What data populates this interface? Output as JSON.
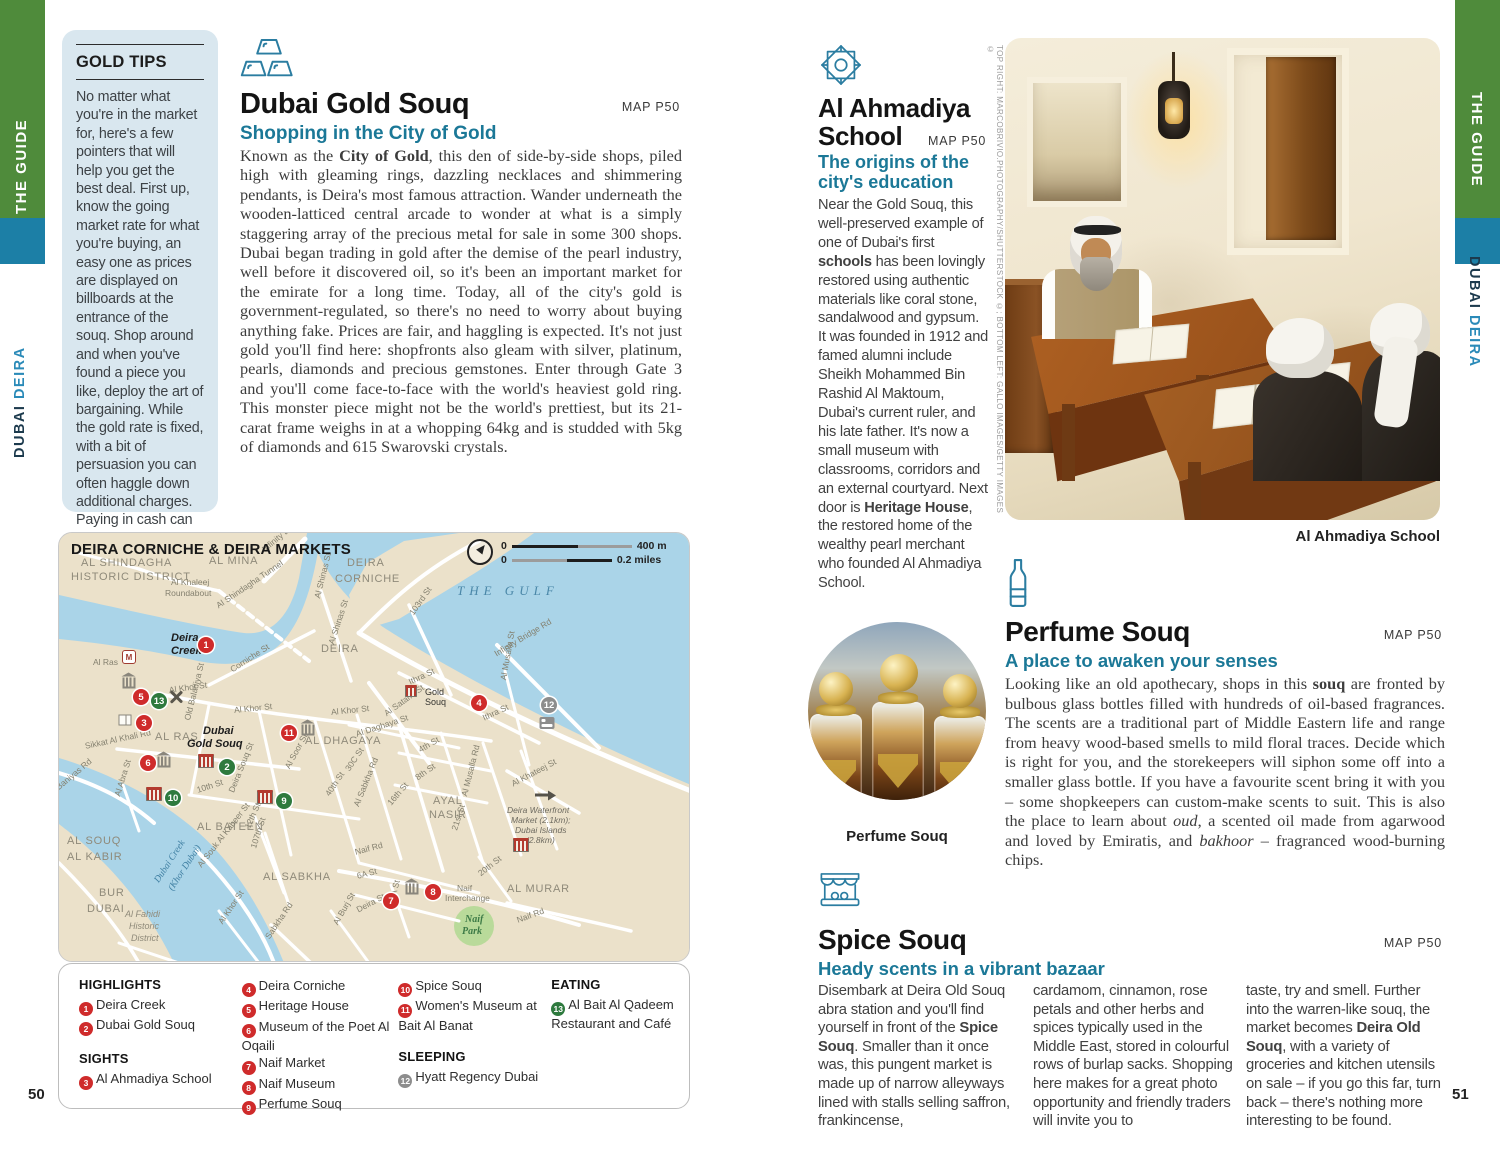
{
  "page": {
    "left_num": "50",
    "right_num": "51"
  },
  "edges": {
    "guide": "THE GUIDE",
    "city": "DUBAI",
    "area": "DEIRA",
    "city_area_down": "DUBAI DEIRA"
  },
  "colors": {
    "accent_teal": "#1b7897",
    "edge_green": "#4f8b3b",
    "edge_blue": "#1c7fa6",
    "marker_red": "#cf2b2b",
    "marker_green": "#2e7a3e",
    "marker_gray": "#8d8d8d"
  },
  "gold_tips": {
    "title": "GOLD TIPS",
    "body": "No matter what you're in the market for, here's a few pointers that will help you get the best deal. First up, know the going market rate for what you're buying, an easy one as prices are displayed on billboards at the entrance of the souq. Shop around and when you've found a piece you like, deploy the art of bargaining. While the gold rate is fixed, with a bit of persuasion you can often haggle down additional charges. Paying in cash can also boost your bargaining power."
  },
  "gold_souq": {
    "title": "Dubai Gold Souq",
    "map_ref": "MAP P50",
    "subtitle": "Shopping in the City of Gold",
    "body": [
      {
        "t": "Known as the "
      },
      {
        "t": "City of Gold",
        "b": true
      },
      {
        "t": ", this den of side-by-side shops, piled high with gleaming rings, dazzling necklaces and shimmering pendants, is Deira's most famous attraction. Wander underneath the wooden-latticed central arcade to wonder at what is a simply staggering array of the precious metal for sale in some 300 shops. Dubai began trading in gold after the demise of the pearl industry, well before it discovered oil, so it's been an important market for the emirate for a long time. Today, all of the city's gold is government-regulated, so there's no need to worry about buying anything fake. Prices are fair, and haggling is expected. It's not just gold you'll find here: shopfronts also gleam with silver, platinum, pearls, diamonds and precious gemstones. Enter through Gate 3 and you'll come face-to-face with the world's heaviest gold ring. This monster piece might not be the world's prettiest, but its 21-carat frame weighs in at a whopping 64kg and is studded with 5kg of diamonds and 615 Swarovski crystals."
      }
    ]
  },
  "ahmadiya": {
    "title_line1": "Al Ahmadiya",
    "title_line2": "School",
    "map_ref": "MAP P50",
    "subtitle": "The origins of the city's education",
    "body": [
      {
        "t": "Near the Gold Souq, this well-preserved example of one of Dubai's first "
      },
      {
        "t": "schools",
        "b": true
      },
      {
        "t": " has been lovingly restored using authentic materials like coral stone, sandalwood and gypsum. It was founded in 1912 and famed alumni include Sheikh Mohammed Bin Rashid Al Maktoum, Dubai's current ruler, and his late father. It's now a small museum with classrooms, corridors and an external courtyard. Next door is "
      },
      {
        "t": "Heritage House",
        "b": true
      },
      {
        "t": ", the restored home of the wealthy pearl merchant who founded Al Ahmadiya School."
      }
    ],
    "photo_caption": "Al Ahmadiya School",
    "credit": "TOP RIGHT: MARCOBRIVIO.PHOTOGRAPHY/SHUTTERSTOCK ©; BOTTOM LEFT: GALLO IMAGES/GETTY IMAGES ©"
  },
  "perfume": {
    "title": "Perfume Souq",
    "map_ref": "MAP P50",
    "subtitle": "A place to awaken your senses",
    "photo_caption": "Perfume Souq",
    "body": [
      {
        "t": "Looking like an old apothecary, shops in this "
      },
      {
        "t": "souq",
        "b": true
      },
      {
        "t": " are fronted by bulbous glass bottles filled with hundreds of oil-based fragrances. The scents are a traditional part of Middle Eastern life and range from heavy wood-based smells to mild floral traces. Decide which is right for you, and the storekeepers will siphon some off into a smaller glass bottle. If you have a favourite scent bring it with you – some shopkeepers can custom-make scents to suit. This is also the place to learn about "
      },
      {
        "t": "oud",
        "i": true
      },
      {
        "t": ", a scented oil made from agarwood and loved by Emiratis, and "
      },
      {
        "t": "bakhoor",
        "i": true
      },
      {
        "t": " – fragranced wood-burning chips."
      }
    ]
  },
  "spice": {
    "title": "Spice Souq",
    "map_ref": "MAP P50",
    "subtitle": "Heady scents in a vibrant bazaar",
    "col1": [
      {
        "t": "Disembark at Deira Old Souq abra station and you'll find yourself in front of the "
      },
      {
        "t": "Spice Souq",
        "b": true
      },
      {
        "t": ". Smaller than it once was, this pungent market is made up of narrow alleyways lined with stalls selling saffron, frankincense,"
      }
    ],
    "col2": [
      {
        "t": "cardamom, cinnamon, rose petals and other herbs and spices typically used in the Middle East, stored in colourful rows of burlap sacks. Shopping here makes for a great photo opportunity and friendly traders will invite you to"
      }
    ],
    "col3": [
      {
        "t": "taste, try and smell. Further into the warren-like souq, the market becomes "
      },
      {
        "t": "Deira Old Souq",
        "b": true
      },
      {
        "t": ", with a variety of groceries and kitchen utensils on sale – if you go this far, turn back – there's nothing more interesting to be found."
      }
    ]
  },
  "map": {
    "title": "DEIRA CORNICHE & DEIRA MARKETS",
    "scale": {
      "zero1": "0",
      "m": "400 m",
      "zero2": "0",
      "mi": "0.2 miles"
    },
    "labels": [
      {
        "t": "AL SHINDAGHA",
        "x": 22,
        "y": 24,
        "cls": "district"
      },
      {
        "t": "HISTORIC DISTRICT",
        "x": 12,
        "y": 38,
        "cls": "district"
      },
      {
        "t": "AL MINA",
        "x": 150,
        "y": 22,
        "cls": "district"
      },
      {
        "t": "DEIRA",
        "x": 288,
        "y": 24,
        "cls": "district"
      },
      {
        "t": "CORNICHE",
        "x": 276,
        "y": 40,
        "cls": "district"
      },
      {
        "t": "THE GULF",
        "x": 398,
        "y": 50,
        "cls": "gulf"
      },
      {
        "t": "DEIRA",
        "x": 262,
        "y": 110,
        "cls": "district"
      },
      {
        "t": "AL RAS",
        "x": 96,
        "y": 198,
        "cls": "district"
      },
      {
        "t": "AL DHAGAYA",
        "x": 246,
        "y": 202,
        "cls": "district"
      },
      {
        "t": "AYAL",
        "x": 374,
        "y": 262,
        "cls": "district"
      },
      {
        "t": "NASIR",
        "x": 370,
        "y": 276,
        "cls": "district"
      },
      {
        "t": "AL BATEEN",
        "x": 138,
        "y": 288,
        "cls": "district"
      },
      {
        "t": "AL SABKHA",
        "x": 204,
        "y": 338,
        "cls": "district"
      },
      {
        "t": "AL SOUQ",
        "x": 8,
        "y": 302,
        "cls": "district"
      },
      {
        "t": "AL KABIR",
        "x": 8,
        "y": 318,
        "cls": "district"
      },
      {
        "t": "BUR",
        "x": 40,
        "y": 354,
        "cls": "district"
      },
      {
        "t": "DUBAI",
        "x": 28,
        "y": 370,
        "cls": "district"
      },
      {
        "t": "AL MURAR",
        "x": 448,
        "y": 350,
        "cls": "district"
      },
      {
        "t": "Al Fahidi",
        "x": 66,
        "y": 376,
        "cls": "hist"
      },
      {
        "t": "Historic",
        "x": 70,
        "y": 388,
        "cls": "hist"
      },
      {
        "t": "District",
        "x": 72,
        "y": 400,
        "cls": "hist"
      },
      {
        "t": "Dubai Creek",
        "x": 98,
        "y": 344,
        "cls": "water",
        "rot": -57
      },
      {
        "t": "(Khor Dubai)",
        "x": 112,
        "y": 352,
        "cls": "water",
        "rot": -57
      },
      {
        "t": "Naif",
        "x": 406,
        "y": 381,
        "cls": "park"
      },
      {
        "t": "Park",
        "x": 403,
        "y": 393,
        "cls": "park"
      },
      {
        "t": "Naif",
        "x": 398,
        "y": 350,
        "cls": "street"
      },
      {
        "t": "Interchange",
        "x": 386,
        "y": 360,
        "cls": "street"
      },
      {
        "t": "Deira",
        "x": 112,
        "y": 99,
        "cls": "place"
      },
      {
        "t": "Creek",
        "x": 112,
        "y": 112,
        "cls": "place"
      },
      {
        "t": "Dubai",
        "x": 144,
        "y": 192,
        "cls": "place"
      },
      {
        "t": "Gold Souq",
        "x": 128,
        "y": 205,
        "cls": "place"
      },
      {
        "t": "Gold",
        "x": 366,
        "y": 154,
        "cls": "splace"
      },
      {
        "t": "Souq",
        "x": 366,
        "y": 164,
        "cls": "splace"
      },
      {
        "t": "Al Ras",
        "x": 34,
        "y": 124,
        "cls": "street"
      },
      {
        "t": "Infinity Bridge",
        "x": 204,
        "y": 12,
        "cls": "street",
        "rot": -40
      },
      {
        "t": "Al Khaleej",
        "x": 112,
        "y": 44,
        "cls": "street"
      },
      {
        "t": "Roundabout",
        "x": 106,
        "y": 55,
        "cls": "street"
      },
      {
        "t": "Al Shindagha Tunnel",
        "x": 158,
        "y": 68,
        "cls": "street",
        "rot": -34
      },
      {
        "t": "Al Shinas St",
        "x": 258,
        "y": 60,
        "cls": "street",
        "rot": -76
      },
      {
        "t": "Al Shinas St",
        "x": 272,
        "y": 106,
        "cls": "street",
        "rot": -72
      },
      {
        "t": "103rd St",
        "x": 352,
        "y": 76,
        "cls": "street",
        "rot": -55
      },
      {
        "t": "Infinity Bridge Rd",
        "x": 436,
        "y": 116,
        "cls": "street",
        "rot": -31
      },
      {
        "t": "Al Musalla St",
        "x": 444,
        "y": 142,
        "cls": "street",
        "rot": -80
      },
      {
        "t": "Ithra St",
        "x": 350,
        "y": 144,
        "cls": "street",
        "rot": -25
      },
      {
        "t": "Ithra St",
        "x": 424,
        "y": 180,
        "cls": "street",
        "rot": -25
      },
      {
        "t": "Corniche St",
        "x": 172,
        "y": 132,
        "cls": "street",
        "rot": -33
      },
      {
        "t": "Al Khor St",
        "x": 110,
        "y": 152,
        "cls": "street",
        "rot": -8
      },
      {
        "t": "Al Khor St",
        "x": 175,
        "y": 172,
        "cls": "street",
        "rot": -6
      },
      {
        "t": "Al Khor St",
        "x": 272,
        "y": 174,
        "cls": "street",
        "rot": -6
      },
      {
        "t": "Al Satami St",
        "x": 326,
        "y": 176,
        "cls": "street",
        "rot": -36
      },
      {
        "t": "Al Daghaya St",
        "x": 297,
        "y": 196,
        "cls": "street",
        "rot": -18
      },
      {
        "t": "4th St",
        "x": 360,
        "y": 212,
        "cls": "street",
        "rot": -30
      },
      {
        "t": "8th St",
        "x": 357,
        "y": 240,
        "cls": "street",
        "rot": -35
      },
      {
        "t": "30C St",
        "x": 288,
        "y": 232,
        "cls": "street",
        "rot": -56
      },
      {
        "t": "40th St",
        "x": 268,
        "y": 257,
        "cls": "street",
        "rot": -56
      },
      {
        "t": "Al Sabkha Rd",
        "x": 297,
        "y": 268,
        "cls": "street",
        "rot": -68
      },
      {
        "t": "16th St",
        "x": 330,
        "y": 266,
        "cls": "street",
        "rot": -50
      },
      {
        "t": "Old Baladiya St",
        "x": 128,
        "y": 182,
        "cls": "street",
        "rot": -76
      },
      {
        "t": "Sikkat Al Khali Rd",
        "x": 26,
        "y": 208,
        "cls": "street",
        "rot": -12
      },
      {
        "t": "Baniyas Rd",
        "x": -2,
        "y": 250,
        "cls": "street",
        "rot": -40
      },
      {
        "t": "Al Abra St",
        "x": 58,
        "y": 258,
        "cls": "street",
        "rot": -73
      },
      {
        "t": "10th St",
        "x": 138,
        "y": 252,
        "cls": "street",
        "rot": -18
      },
      {
        "t": "Deira Souq St",
        "x": 172,
        "y": 254,
        "cls": "street",
        "rot": -68
      },
      {
        "t": "Al Soor St",
        "x": 228,
        "y": 230,
        "cls": "street",
        "rot": -62
      },
      {
        "t": "12th St",
        "x": 188,
        "y": 290,
        "cls": "street",
        "rot": -66
      },
      {
        "t": "107th St",
        "x": 194,
        "y": 310,
        "cls": "street",
        "rot": -72
      },
      {
        "t": "Al Souk Al Kabeer St",
        "x": 140,
        "y": 328,
        "cls": "street",
        "rot": -52
      },
      {
        "t": "Al Khor St",
        "x": 161,
        "y": 385,
        "cls": "street",
        "rot": -56
      },
      {
        "t": "Sabkha Rd",
        "x": 208,
        "y": 400,
        "cls": "street",
        "rot": -56
      },
      {
        "t": "Al Burj St",
        "x": 276,
        "y": 386,
        "cls": "street",
        "rot": -60
      },
      {
        "t": "6A St",
        "x": 298,
        "y": 338,
        "cls": "street",
        "rot": -15
      },
      {
        "t": "Deira St",
        "x": 298,
        "y": 372,
        "cls": "street",
        "rot": -28
      },
      {
        "t": "9A St",
        "x": 333,
        "y": 362,
        "cls": "street",
        "rot": -76
      },
      {
        "t": "Naif Rd",
        "x": 296,
        "y": 314,
        "cls": "street",
        "rot": -15
      },
      {
        "t": "Naif Rd",
        "x": 458,
        "y": 382,
        "cls": "street",
        "rot": -20
      },
      {
        "t": "20th St",
        "x": 420,
        "y": 336,
        "cls": "street",
        "rot": -38
      },
      {
        "t": "21st St",
        "x": 395,
        "y": 292,
        "cls": "street",
        "rot": -72
      },
      {
        "t": "Al Musalla Rd",
        "x": 405,
        "y": 258,
        "cls": "street",
        "rot": -76
      },
      {
        "t": "Al Khateej St",
        "x": 453,
        "y": 246,
        "cls": "street",
        "rot": -28
      },
      {
        "t": "Deira Waterfront",
        "x": 448,
        "y": 272,
        "cls": "note"
      },
      {
        "t": "Market (2.1km);",
        "x": 452,
        "y": 282,
        "cls": "note"
      },
      {
        "t": "Dubai Islands",
        "x": 456,
        "y": 292,
        "cls": "note"
      },
      {
        "t": "(2.8km)",
        "x": 467,
        "y": 302,
        "cls": "note"
      }
    ],
    "markers": [
      {
        "n": "1",
        "x": 147,
        "y": 112,
        "c": "r"
      },
      {
        "n": "2",
        "x": 168,
        "y": 234,
        "c": "g"
      },
      {
        "n": "3",
        "x": 85,
        "y": 190,
        "c": "r"
      },
      {
        "n": "4",
        "x": 420,
        "y": 170,
        "c": "r"
      },
      {
        "n": "5",
        "x": 82,
        "y": 164,
        "c": "r"
      },
      {
        "n": "6",
        "x": 89,
        "y": 230,
        "c": "r"
      },
      {
        "n": "7",
        "x": 332,
        "y": 368,
        "c": "r"
      },
      {
        "n": "8",
        "x": 374,
        "y": 359,
        "c": "r"
      },
      {
        "n": "9",
        "x": 225,
        "y": 268,
        "c": "g"
      },
      {
        "n": "10",
        "x": 114,
        "y": 265,
        "c": "g"
      },
      {
        "n": "11",
        "x": 230,
        "y": 200,
        "c": "r"
      },
      {
        "n": "12",
        "x": 490,
        "y": 172,
        "c": "y"
      },
      {
        "n": "13",
        "x": 100,
        "y": 168,
        "c": "g"
      }
    ],
    "icons": [
      {
        "t": "metro",
        "x": 70,
        "y": 124
      },
      {
        "t": "museum",
        "x": 70,
        "y": 150
      },
      {
        "t": "book",
        "x": 66,
        "y": 187
      },
      {
        "t": "fork",
        "x": 117,
        "y": 164
      },
      {
        "t": "museum",
        "x": 105,
        "y": 229
      },
      {
        "t": "souq",
        "x": 147,
        "y": 228
      },
      {
        "t": "souq",
        "x": 95,
        "y": 261
      },
      {
        "t": "souq",
        "x": 206,
        "y": 264
      },
      {
        "t": "museum",
        "x": 249,
        "y": 197
      },
      {
        "t": "museum",
        "x": 353,
        "y": 356
      },
      {
        "t": "bed",
        "x": 488,
        "y": 190
      },
      {
        "t": "souqsm",
        "x": 352,
        "y": 158
      },
      {
        "t": "arrow",
        "x": 483,
        "y": 262
      },
      {
        "t": "souq",
        "x": 462,
        "y": 312
      }
    ],
    "legend": {
      "columns": [
        [
          {
            "header": "HIGHLIGHTS",
            "items": [
              {
                "n": "1",
                "c": "r",
                "t": "Deira Creek"
              },
              {
                "n": "2",
                "c": "r",
                "t": "Dubai Gold Souq"
              }
            ]
          },
          {
            "header": "SIGHTS",
            "items": [
              {
                "n": "3",
                "c": "r",
                "t": "Al Ahmadiya School"
              }
            ]
          }
        ],
        [
          {
            "items": [
              {
                "n": "4",
                "c": "r",
                "t": "Deira Corniche"
              },
              {
                "n": "5",
                "c": "r",
                "t": "Heritage House"
              },
              {
                "n": "6",
                "c": "r",
                "t": "Museum of the Poet Al Oqaili"
              },
              {
                "n": "7",
                "c": "r",
                "t": "Naif Market"
              },
              {
                "n": "8",
                "c": "r",
                "t": "Naif Museum"
              },
              {
                "n": "9",
                "c": "r",
                "t": "Perfume Souq"
              }
            ]
          }
        ],
        [
          {
            "items": [
              {
                "n": "10",
                "c": "r",
                "t": "Spice Souq"
              },
              {
                "n": "11",
                "c": "r",
                "t": "Women's Museum at Bait Al Banat"
              }
            ]
          },
          {
            "header": "SLEEPING",
            "items": [
              {
                "n": "12",
                "c": "y",
                "t": "Hyatt Regency Dubai"
              }
            ]
          }
        ],
        [
          {
            "header": "EATING",
            "items": [
              {
                "n": "13",
                "c": "g",
                "t": "Al Bait Al Qadeem Restaurant and Café"
              }
            ]
          }
        ]
      ]
    }
  }
}
